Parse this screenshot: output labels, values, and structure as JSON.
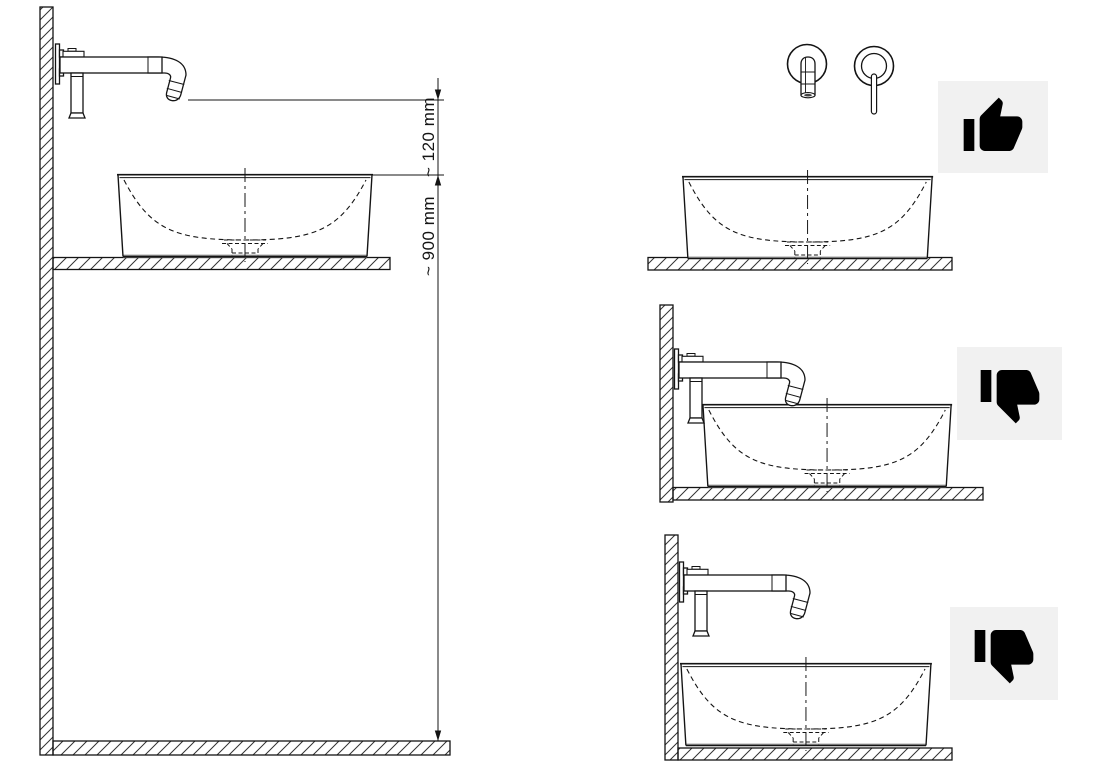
{
  "document": {
    "kind": "installation-diagram",
    "background": "#ffffff"
  },
  "colors": {
    "line": "#141414",
    "hatch": "#333333",
    "basin_shadow": "#9b9b9b",
    "icon_box_bg": "#f1f1f1",
    "icon_color": "#000000"
  },
  "main_diagram": {
    "dimension_spout_to_rim": "~ 120 mm",
    "dimension_rim_to_floor": "~ 900 mm"
  },
  "examples": [
    {
      "verdict": "correct",
      "icon": "thumbs-up-icon"
    },
    {
      "verdict": "incorrect",
      "icon": "thumbs-down-icon"
    },
    {
      "verdict": "incorrect",
      "icon": "thumbs-down-icon"
    }
  ]
}
